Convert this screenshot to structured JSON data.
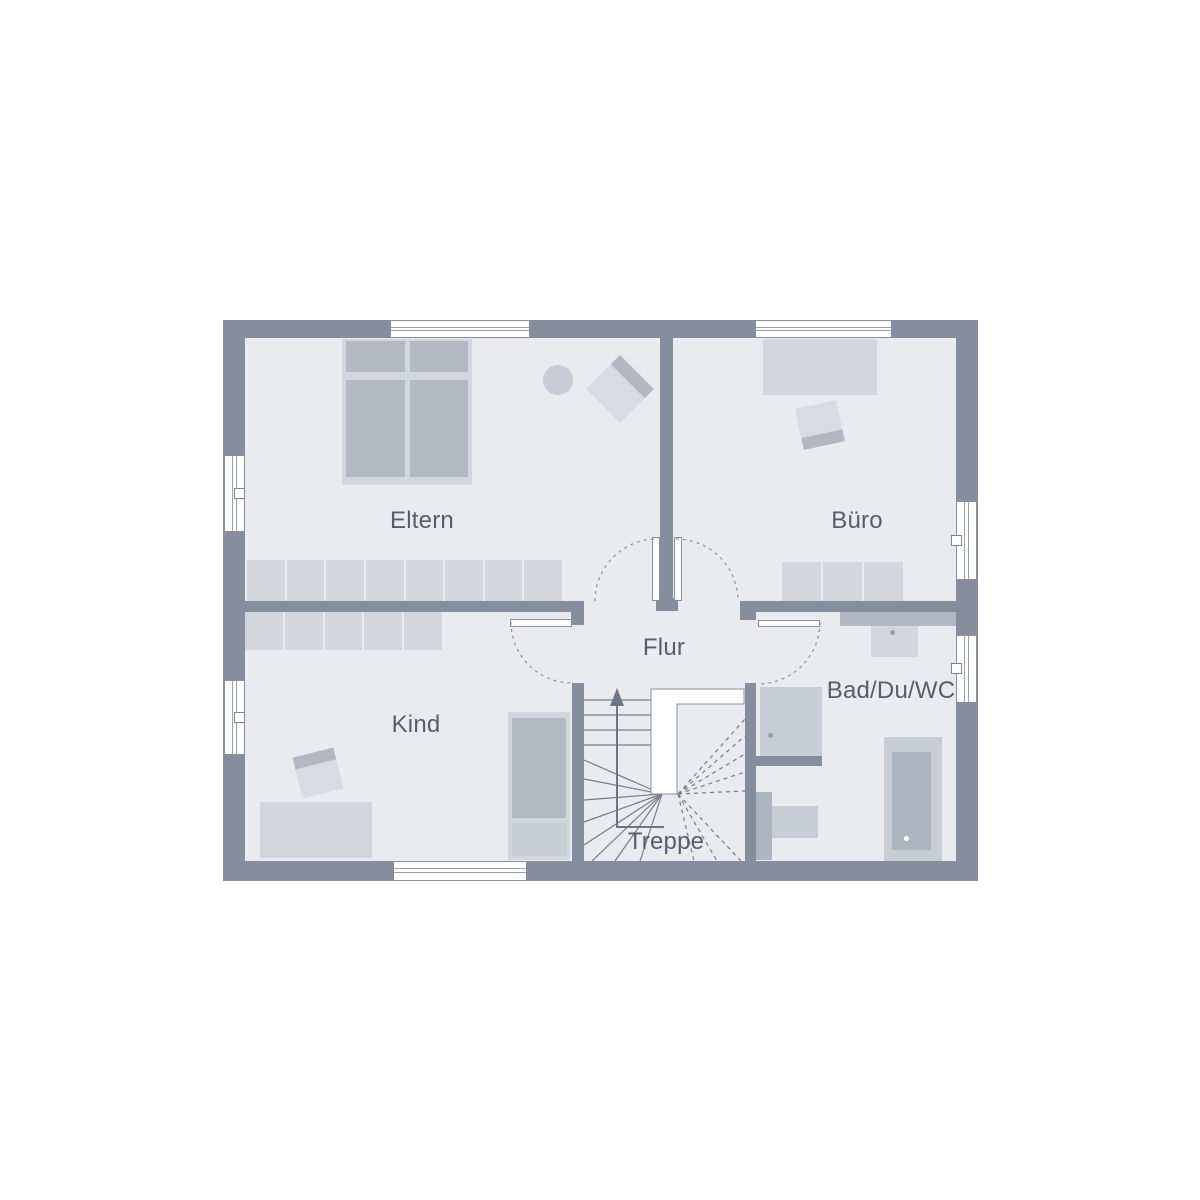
{
  "plan_type": "floor-plan",
  "rooms": {
    "eltern": {
      "label": "Eltern"
    },
    "buero": {
      "label": "Büro"
    },
    "kind": {
      "label": "Kind"
    },
    "flur": {
      "label": "Flur"
    },
    "bad": {
      "label": "Bad/Du/WC"
    },
    "treppe": {
      "label": "Treppe"
    }
  },
  "furniture": {
    "wardrobe_eltern_sections": 8,
    "wardrobe_kind_sections": 5,
    "cabinet_buero_sections": 3,
    "items": [
      "double-bed",
      "wardrobe",
      "armchair",
      "stool",
      "desk",
      "office-chair",
      "single-bed",
      "cabinet",
      "shower",
      "washbasin",
      "bathtub",
      "toilet",
      "winder-staircase",
      "direction-arrow"
    ]
  },
  "colors": {
    "background": "#ffffff",
    "wall": "#868d9c",
    "floor": "#e9ebef",
    "furniture_light": "#d3d6dd",
    "furniture_mid": "#c8ccd4",
    "furniture_dark": "#b3b8c3",
    "chair_seat": "#d8dbe1",
    "chair_back": "#b2b7c2",
    "stair_line": "#767d8d",
    "dashed_line": "#8d93a2",
    "window_fill": "#ffffff",
    "text": "#575d69"
  }
}
